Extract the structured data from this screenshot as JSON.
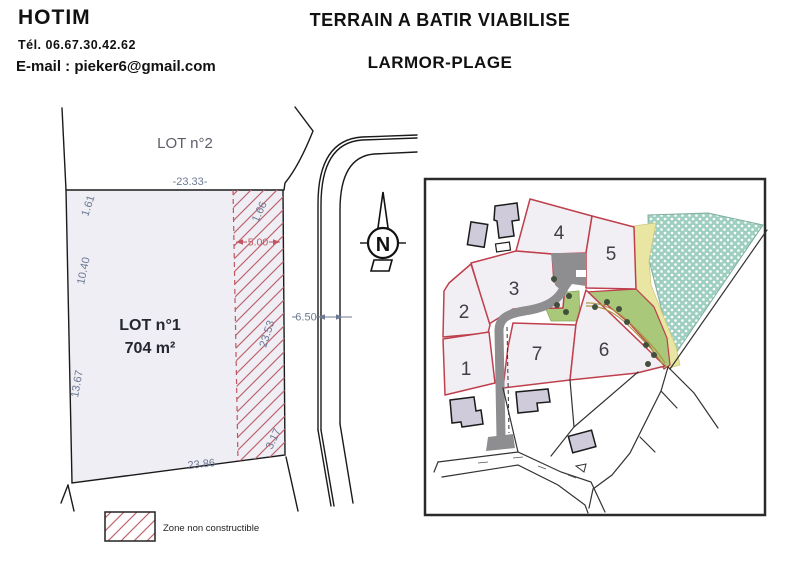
{
  "header": {
    "company": "HOTIM",
    "phone": "Tél. 06.67.30.42.62",
    "email": "E-mail : pieker6@gmail.com"
  },
  "title": {
    "main": "TERRAIN A BATIR VIABILISE",
    "location": "LARMOR-PLAGE"
  },
  "plot_plan": {
    "lot2_label": "LOT n°2",
    "lot1_label": "LOT n°1",
    "lot1_area": "704 m²",
    "dim_top": "-23.33-",
    "dim_left_1": "1.61",
    "dim_left_2": "10.40",
    "dim_left_3": "13.67",
    "dim_right_1": "1.66",
    "dim_right_2": "23.53",
    "dim_right_3": "3.17",
    "dim_bottom": "23.86",
    "dim_hatch_width": "5.00",
    "dim_road_width": "6.50",
    "north_label": "N",
    "legend_label": "Zone non constructible"
  },
  "site_map": {
    "lots": [
      {
        "label": "1",
        "highlighted": true
      },
      {
        "label": "2"
      },
      {
        "label": "3"
      },
      {
        "label": "4"
      },
      {
        "label": "5"
      },
      {
        "label": "6"
      },
      {
        "label": "7"
      }
    ]
  },
  "colors": {
    "dimension_blue": "#6d7a94",
    "hatch_red": "#c05660",
    "lot_outline_red": "#bf3f4d",
    "lot1_pink": "#eec6cb",
    "lot_fill": "#f1eff4",
    "road_gray": "#8e8e90",
    "green_strip": "#a9c87a",
    "yellow_band": "#e9e6a3",
    "teal_wood": "#9fcfc0",
    "building_fill": "#cfcbdb"
  }
}
